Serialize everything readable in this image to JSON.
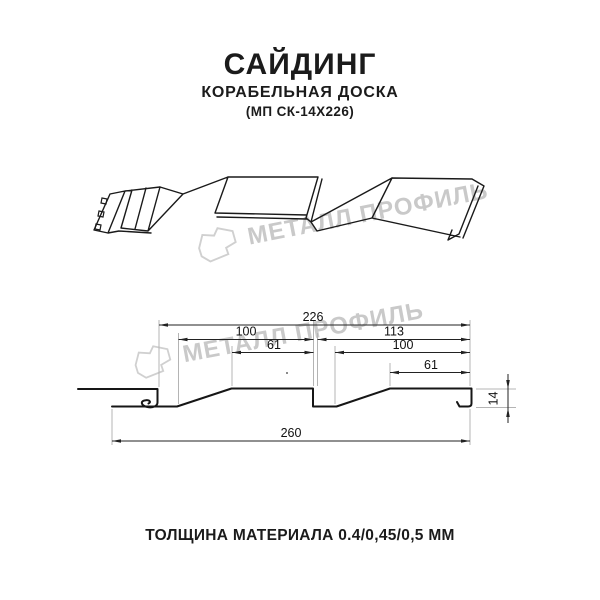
{
  "header": {
    "title": "САЙДИНГ",
    "subtitle": "КОРАБЕЛЬНАЯ ДОСКА",
    "model": "(МП СК-14Х226)"
  },
  "watermark": {
    "brand": "МЕТАЛЛ ПРОФИЛЬ",
    "color": "#c9c9c9"
  },
  "drawing": {
    "dimensions": {
      "overall_profile_width": "226",
      "left_wave_pitch": "100",
      "right_wave_pitch": "113",
      "left_wave_flat": "61",
      "right_wave_inner": "100",
      "right_wave_flat": "61",
      "total_sheet_width": "260",
      "profile_height": "14"
    }
  },
  "footer": {
    "thickness_label": "ТОЛЩИНА МАТЕРИАЛА 0.4/0,45/0,5 ММ"
  }
}
